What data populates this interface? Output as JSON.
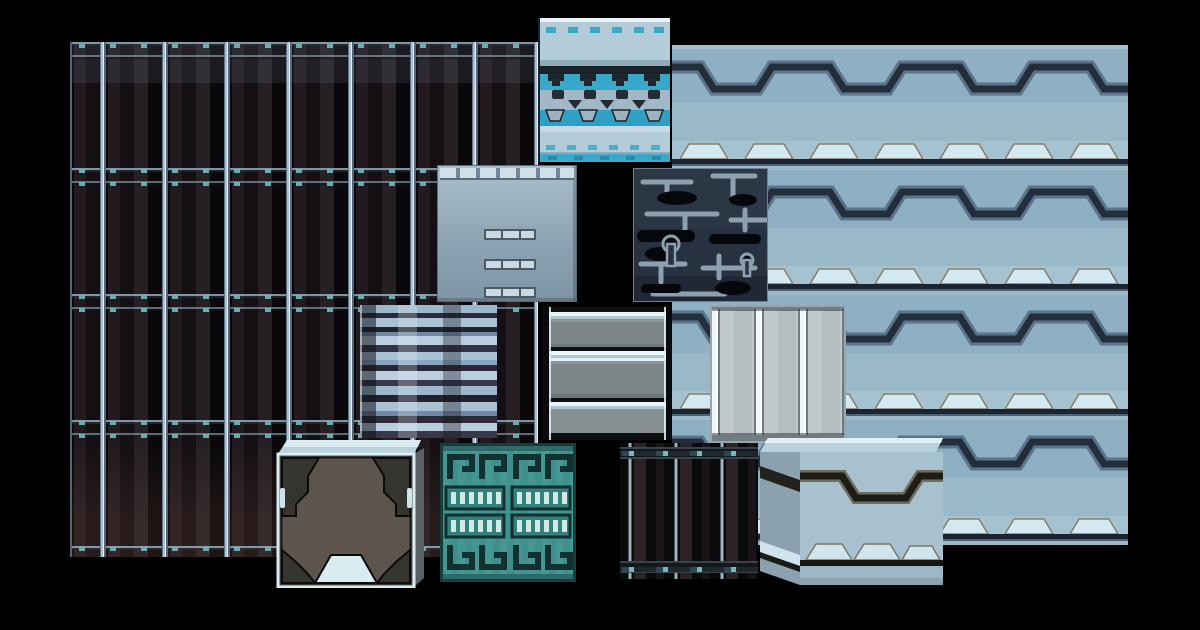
{
  "page": {
    "title": "Sci-fi tileset texture sheet",
    "background": "#000000"
  },
  "palette": {
    "background": "#000000",
    "dark_wall_base": "#14100f",
    "seam_light": "#aebfd0",
    "teal_accent": "#6fb9c0",
    "light_wall_base": "#8fb0c2",
    "trim_dark": "#242e3b",
    "bump_light": "#d3e9f1",
    "cyan": "#38a8ca",
    "steel": "#a2b8c6",
    "pipe_panel": "#27313f",
    "teal_crate": "#3f8f8c",
    "crate_brown": "#5d554c",
    "glow_white": "#eef8fb"
  },
  "tiles": [
    {
      "id": "dark-wall-panels",
      "label": "Dark metal wall with glowing vertical seams",
      "x": 70,
      "y": 42,
      "width": 468,
      "height": 515
    },
    {
      "id": "light-wall-zigzag",
      "label": "Light armored wall with dark zigzag trim",
      "x": 672,
      "y": 45,
      "width": 456,
      "height": 500
    },
    {
      "id": "cyan-strip-tile",
      "label": "Cyan banded mechanical strip tile",
      "x": 538,
      "y": 18,
      "width": 132,
      "height": 144
    },
    {
      "id": "vent-panel",
      "label": "Gray panel with three vent slots",
      "x": 437,
      "y": 165,
      "width": 140,
      "height": 137
    },
    {
      "id": "pipe-channel-tile",
      "label": "Dark navy panel with pipe channels",
      "x": 633,
      "y": 168,
      "width": 135,
      "height": 134
    },
    {
      "id": "glitch-panel",
      "label": "Corrupted static data panel",
      "x": 360,
      "y": 305,
      "width": 137,
      "height": 133
    },
    {
      "id": "ridged-barrel",
      "label": "Gray ridged container with light bands",
      "x": 543,
      "y": 307,
      "width": 129,
      "height": 133
    },
    {
      "id": "column-panel",
      "label": "Light panel with glowing vertical columns",
      "x": 710,
      "y": 305,
      "width": 136,
      "height": 138
    },
    {
      "id": "armored-crate-dark",
      "label": "Dark crate with corner plating",
      "x": 275,
      "y": 438,
      "width": 150,
      "height": 150
    },
    {
      "id": "teal-circuit-crate",
      "label": "Teal crate with circuit meander pattern",
      "x": 440,
      "y": 443,
      "width": 136,
      "height": 139
    },
    {
      "id": "dark-striped-block",
      "label": "Dark striped block with teal rivets",
      "x": 620,
      "y": 443,
      "width": 138,
      "height": 136
    },
    {
      "id": "armored-crate-light",
      "label": "Light blue crate with zigzag plating",
      "x": 750,
      "y": 438,
      "width": 195,
      "height": 147
    }
  ]
}
